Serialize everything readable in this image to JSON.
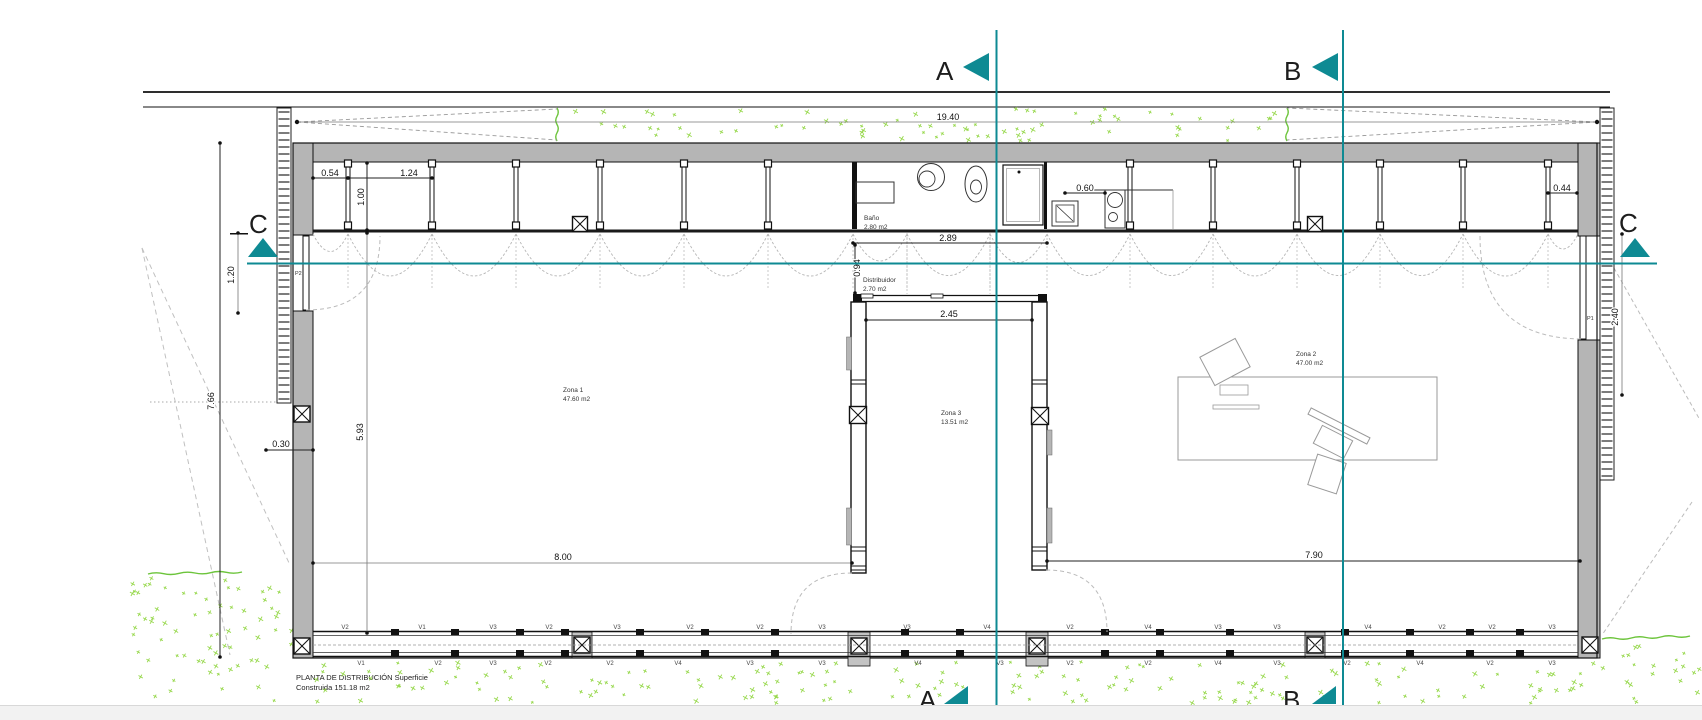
{
  "palette": {
    "teal": "#0e8a93",
    "wall_gray": "#b5b5b5",
    "column_gray": "#c3c3c3",
    "speckle_green": "#97d84c",
    "wavy_green": "#6cc43b",
    "line_dark": "#111111",
    "dim_gray": "#777777",
    "arc_gray": "#b5b5b5",
    "bottom_bar": "#f2f2f2"
  },
  "sections": {
    "a": "A",
    "b": "B",
    "c": "C"
  },
  "title": {
    "line1": "PLANTA DE DISTRIBUCIÓN Superficie",
    "line2": "Construida  151.18 m2"
  },
  "rooms": [
    {
      "name": "Zona 1",
      "area": "47.60 m2"
    },
    {
      "name": "Zona 2",
      "area": "47.00 m2"
    },
    {
      "name": "Zona 3",
      "area": "13.51 m2"
    },
    {
      "name": "Baño",
      "area": "2.80 m2"
    },
    {
      "name": "Distribuidor",
      "area": "2.70 m2"
    }
  ],
  "doors": [
    {
      "label": "P2"
    },
    {
      "label": "P1"
    }
  ],
  "dimensions": [
    {
      "text": "19.40",
      "x": 948,
      "y": 120,
      "rot": 0
    },
    {
      "text": "0.54",
      "x": 330,
      "y": 176,
      "rot": 0
    },
    {
      "text": "1.24",
      "x": 409,
      "y": 176,
      "rot": 0
    },
    {
      "text": "1.00",
      "x": 364,
      "y": 197,
      "rot": -90
    },
    {
      "text": "0.60",
      "x": 1085,
      "y": 191,
      "rot": 0
    },
    {
      "text": "0.44",
      "x": 1562,
      "y": 191,
      "rot": 0
    },
    {
      "text": "2.89",
      "x": 948,
      "y": 241,
      "rot": 0
    },
    {
      "text": "0.94",
      "x": 860,
      "y": 268,
      "rot": -90
    },
    {
      "text": "2.45",
      "x": 949,
      "y": 317,
      "rot": 0
    },
    {
      "text": "8.00",
      "x": 563,
      "y": 560,
      "rot": 0
    },
    {
      "text": "7.90",
      "x": 1314,
      "y": 558,
      "rot": 0
    },
    {
      "text": "0.30",
      "x": 281,
      "y": 447,
      "rot": 0
    },
    {
      "text": "5.93",
      "x": 363,
      "y": 432,
      "rot": -90
    },
    {
      "text": "7.66",
      "x": 214,
      "y": 401,
      "rot": -90
    },
    {
      "text": "1.20",
      "x": 234,
      "y": 275,
      "rot": -90
    },
    {
      "text": "2.40",
      "x": 1618,
      "y": 317,
      "rot": -90
    }
  ],
  "windows_top": [
    {
      "x": 345,
      "label": "V2"
    },
    {
      "x": 422,
      "label": "V1"
    },
    {
      "x": 493,
      "label": "V3"
    },
    {
      "x": 549,
      "label": "V2"
    },
    {
      "x": 617,
      "label": "V3"
    },
    {
      "x": 690,
      "label": "V2"
    },
    {
      "x": 760,
      "label": "V2"
    },
    {
      "x": 822,
      "label": "V3"
    },
    {
      "x": 907,
      "label": "V3"
    },
    {
      "x": 987,
      "label": "V4"
    },
    {
      "x": 1070,
      "label": "V2"
    },
    {
      "x": 1148,
      "label": "V4"
    },
    {
      "x": 1218,
      "label": "V3"
    },
    {
      "x": 1277,
      "label": "V3"
    },
    {
      "x": 1368,
      "label": "V4"
    },
    {
      "x": 1442,
      "label": "V2"
    },
    {
      "x": 1492,
      "label": "V2"
    },
    {
      "x": 1552,
      "label": "V3"
    }
  ],
  "windows_bottom": [
    {
      "x": 361,
      "label": "V1"
    },
    {
      "x": 438,
      "label": "V2"
    },
    {
      "x": 493,
      "label": "V3"
    },
    {
      "x": 548,
      "label": "V2"
    },
    {
      "x": 610,
      "label": "V2"
    },
    {
      "x": 678,
      "label": "V4"
    },
    {
      "x": 750,
      "label": "V3"
    },
    {
      "x": 822,
      "label": "V3"
    },
    {
      "x": 918,
      "label": "V4"
    },
    {
      "x": 1000,
      "label": "V3"
    },
    {
      "x": 1070,
      "label": "V2"
    },
    {
      "x": 1148,
      "label": "V2"
    },
    {
      "x": 1218,
      "label": "V4"
    },
    {
      "x": 1277,
      "label": "V3"
    },
    {
      "x": 1347,
      "label": "V2"
    },
    {
      "x": 1420,
      "label": "V4"
    },
    {
      "x": 1490,
      "label": "V2"
    },
    {
      "x": 1552,
      "label": "V3"
    }
  ]
}
